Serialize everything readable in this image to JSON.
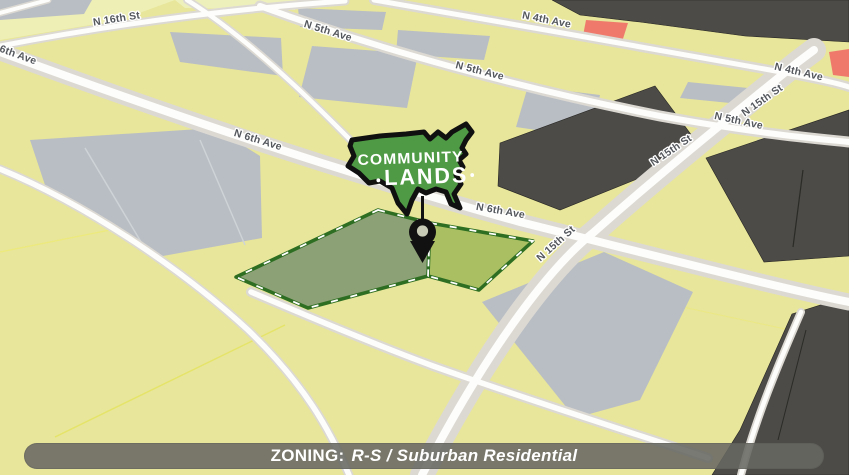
{
  "map": {
    "street_labels": [
      {
        "text": "N 16th St"
      },
      {
        "text": "6th Ave"
      },
      {
        "text": "N 5th Ave"
      },
      {
        "text": "N 5th Ave"
      },
      {
        "text": "N 5th Ave"
      },
      {
        "text": "N 4th Ave"
      },
      {
        "text": "N 4th Ave"
      },
      {
        "text": "N 15th St"
      },
      {
        "text": "N 15th St"
      },
      {
        "text": "N 15th St"
      },
      {
        "text": "N 6th Ave"
      },
      {
        "text": "N 6th Ave"
      }
    ],
    "colors": {
      "parcel_yellow": "#e8e69a",
      "parcel_yellow_light": "#eeefb4",
      "parcel_gray": "#b9bec4",
      "building_dark": "#4d4b48",
      "parcel_red": "#ef7a6c",
      "road_casing": "#dcd9d3",
      "road_core": "#fdfdfb",
      "highlight_border_green": "#2d6e22",
      "highlight_fill_muted": "#8ca175",
      "highlight_fill_bright": "#a9bf62",
      "label_gray": "#54585d"
    }
  },
  "logo": {
    "line1": "COMMUNITY",
    "line2": "LANDS",
    "green": "#4f9b45"
  },
  "zoning_bar": {
    "label": "ZONING:",
    "value": "R-S / Suburban Residential"
  }
}
